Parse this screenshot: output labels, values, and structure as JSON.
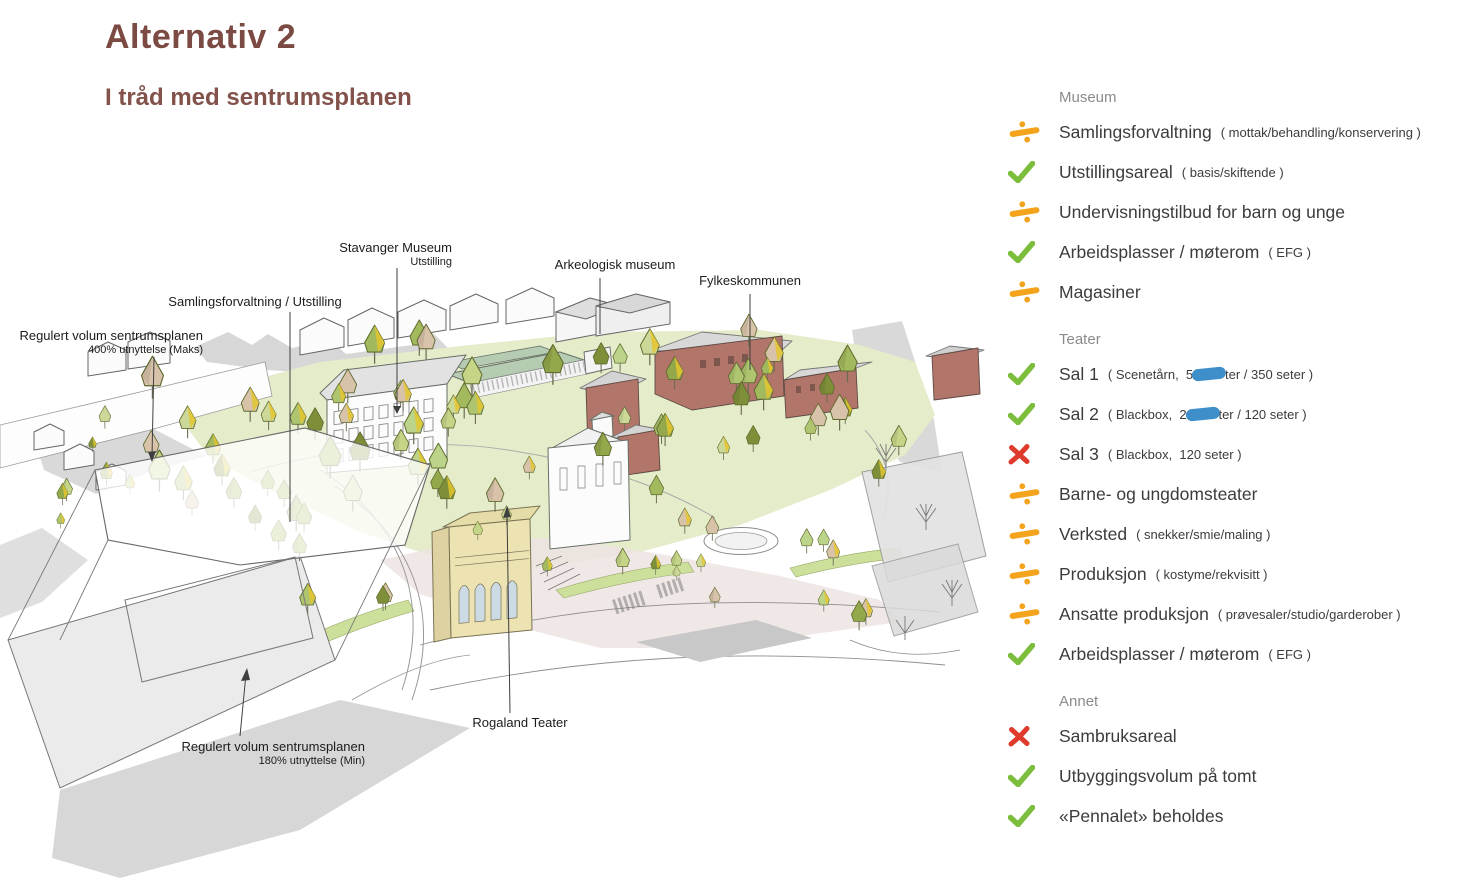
{
  "page": {
    "title": "Alternativ 2",
    "subtitle": "I tråd med sentrumsplanen"
  },
  "illustration": {
    "labels": {
      "stavanger_museum": {
        "text": "Stavanger Museum",
        "sub": "Utstilling"
      },
      "samlingsforvaltning": {
        "text": "Samlingsforvaltning / Utstilling"
      },
      "arkeologisk": {
        "text": "Arkeologisk museum"
      },
      "fylkeskommunen": {
        "text": "Fylkeskommunen"
      },
      "regulert_maks": {
        "text": "Regulert volum sentrumsplanen",
        "sub": "400% utnyttelse (Maks)"
      },
      "rogaland_teater": {
        "text": "Rogaland Teater"
      },
      "regulert_min": {
        "text": "Regulert volum sentrumsplanen",
        "sub": "180% utnyttelse (Min)"
      }
    }
  },
  "checklist": {
    "sections": [
      {
        "heading": "Museum",
        "items": [
          {
            "status": "partial",
            "label": "Samlingsforvaltning",
            "detail": "( mottak/behandling/konservering )"
          },
          {
            "status": "yes",
            "label": "Utstillingsareal",
            "detail": "( basis/skiftende )"
          },
          {
            "status": "partial",
            "label": "Undervisningstilbud for barn og unge",
            "detail": ""
          },
          {
            "status": "yes",
            "label": "Arbeidsplasser / møterom",
            "detail": "( EFG )"
          },
          {
            "status": "partial",
            "label": "Magasiner",
            "detail": ""
          }
        ]
      },
      {
        "heading": "Teater",
        "items": [
          {
            "status": "yes",
            "label": "Sal 1",
            "detail_pre": "( Scenetårn,  5",
            "detail_marked": "50 se",
            "detail_post": "ter / 350 seter )",
            "annotation": "blue-marker"
          },
          {
            "status": "yes",
            "label": "Sal 2",
            "detail_pre": "( Blackbox,  2",
            "detail_marked": "20 se",
            "detail_post": "ter / 120 seter )",
            "annotation": "blue-marker"
          },
          {
            "status": "no",
            "label": "Sal 3",
            "detail": "( Blackbox,  120 seter )"
          },
          {
            "status": "partial",
            "label": "Barne- og ungdomsteater",
            "detail": ""
          },
          {
            "status": "partial",
            "label": "Verksted",
            "detail": "( snekker/smie/maling )"
          },
          {
            "status": "partial",
            "label": "Produksjon",
            "detail": "( kostyme/rekvisitt )"
          },
          {
            "status": "partial",
            "label": "Ansatte produksjon",
            "detail": "( prøvesaler/studio/garderober )"
          },
          {
            "status": "yes",
            "label": "Arbeidsplasser / møterom",
            "detail": "( EFG )"
          }
        ]
      },
      {
        "heading": "Annet",
        "items": [
          {
            "status": "no",
            "label": "Sambruksareal",
            "detail": ""
          },
          {
            "status": "yes",
            "label": "Utbyggingsvolum på tomt",
            "detail": ""
          },
          {
            "status": "yes",
            "label": "«Pennalet» beholdes",
            "detail": ""
          }
        ]
      }
    ]
  },
  "colors": {
    "title_maroon": "#7b4a43",
    "subtitle_maroon": "#82524b",
    "check_green": "#7cbd3c",
    "divide_orange": "#f3a31c",
    "cross_red": "#de3b2c",
    "marker_blue": "#3d8ec9",
    "heading_grey": "#8b8b8b",
    "text_dark": "#3c3c3c"
  }
}
